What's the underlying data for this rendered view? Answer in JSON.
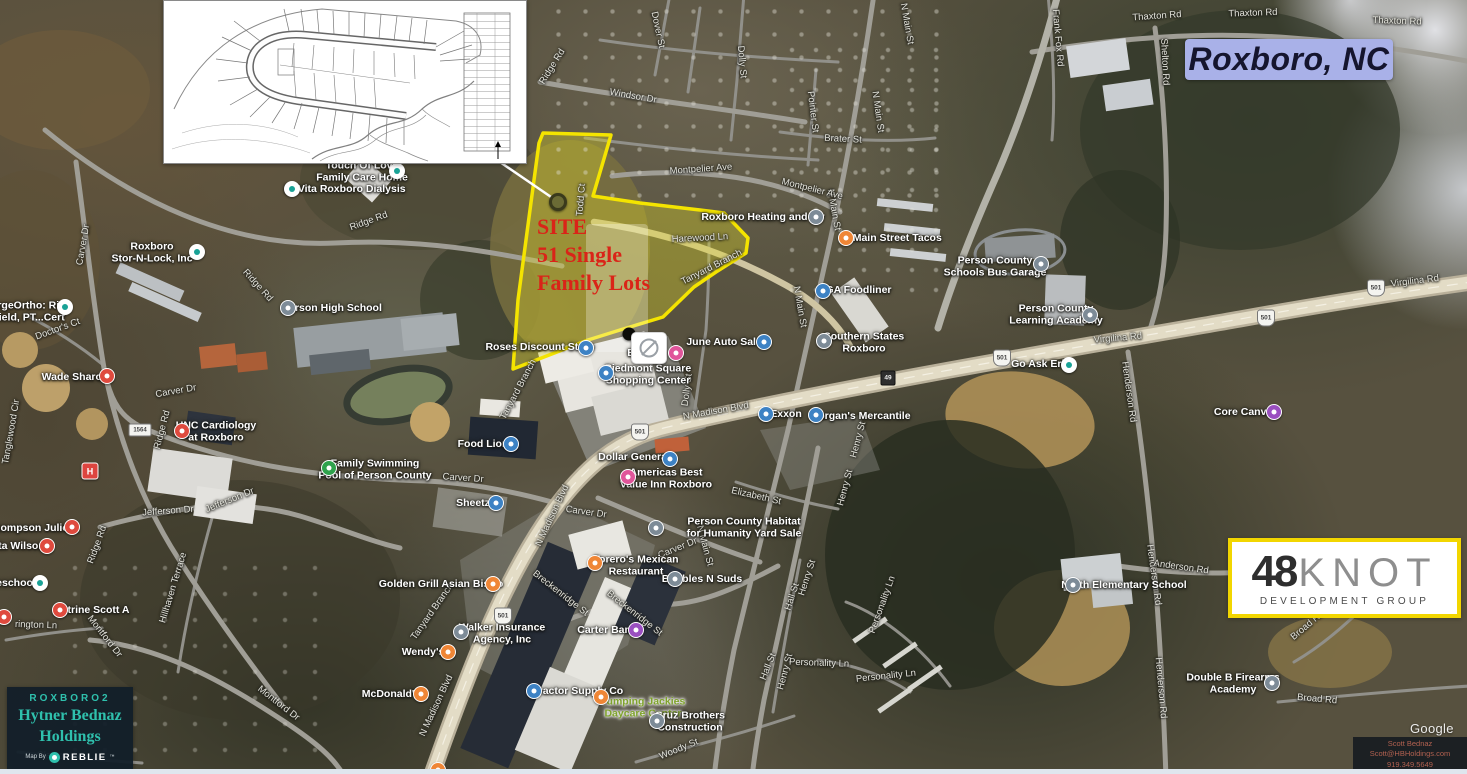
{
  "title": "Roxboro, NC",
  "callout": {
    "line1": "SITE",
    "line2": "51 Single",
    "line3": "Family Lots"
  },
  "logo": {
    "number": "48",
    "word": "KNOT",
    "subtitle": "DEVELOPMENT GROUP"
  },
  "branding": {
    "project": "ROXBORO2",
    "company_line1": "Hytner Bednaz",
    "company_line2": "Holdings",
    "map_by": "Map By",
    "brand": "REBLIE",
    "trademark": "™"
  },
  "contact": {
    "name": "Scott Bednaz",
    "email": "Scott@HBHoldings.com",
    "phone": "919.349.5649"
  },
  "watermark": "Google",
  "colors": {
    "site_outline": "#f4e400",
    "callout_red": "#da2418",
    "title_bg": "#a9b1e8",
    "brand_teal": "#2fc0ad",
    "logo_border_yellow": "#f2d600",
    "green_label": "#7fa32c"
  },
  "map": {
    "labels": [
      {
        "t": "Thaxton Rd",
        "x": 1157,
        "y": 17,
        "r": -4
      },
      {
        "t": "Thaxton Rd",
        "x": 1253,
        "y": 14,
        "r": -2
      },
      {
        "t": "Thaxton Rd",
        "x": 1397,
        "y": 22,
        "r": 2
      },
      {
        "t": "Frank Fox Rd",
        "x": 1057,
        "y": 38,
        "r": 85
      },
      {
        "t": "Shelton Rd",
        "x": 1164,
        "y": 62,
        "r": 87
      },
      {
        "t": "Ridge Rd",
        "x": 553,
        "y": 67,
        "r": -58
      },
      {
        "t": "Dover St",
        "x": 657,
        "y": 30,
        "r": 78
      },
      {
        "t": "Dolly St",
        "x": 741,
        "y": 62,
        "r": 85
      },
      {
        "t": "Windsor Dr",
        "x": 633,
        "y": 97,
        "r": 10
      },
      {
        "t": "Pointer St",
        "x": 812,
        "y": 112,
        "r": 83
      },
      {
        "t": "Brater St",
        "x": 843,
        "y": 140,
        "r": 3
      },
      {
        "t": "N Main St",
        "x": 906,
        "y": 24,
        "r": 80
      },
      {
        "t": "N Main St",
        "x": 877,
        "y": 112,
        "r": 82
      },
      {
        "t": "N Main St",
        "x": 833,
        "y": 210,
        "r": 80
      },
      {
        "t": "N Main St",
        "x": 799,
        "y": 307,
        "r": 80
      },
      {
        "t": "N Main St",
        "x": 704,
        "y": 546,
        "r": 75
      },
      {
        "t": "Montpelier Ave",
        "x": 701,
        "y": 170,
        "r": -4
      },
      {
        "t": "Montpelier Ave",
        "x": 812,
        "y": 190,
        "r": 14
      },
      {
        "t": "Todd Ct",
        "x": 582,
        "y": 200,
        "r": -85
      },
      {
        "t": "Harewood Ln",
        "x": 700,
        "y": 239,
        "r": -3
      },
      {
        "t": "Tanyard Branch",
        "x": 712,
        "y": 268,
        "r": -27
      },
      {
        "t": "Tanyard Branch",
        "x": 519,
        "y": 390,
        "r": -62
      },
      {
        "t": "Tanyard Branch",
        "x": 433,
        "y": 612,
        "r": -55
      },
      {
        "t": "Ridge Rd",
        "x": 369,
        "y": 222,
        "r": -20
      },
      {
        "t": "Ridge Rd",
        "x": 257,
        "y": 286,
        "r": 48
      },
      {
        "t": "Ridge Rd",
        "x": 163,
        "y": 430,
        "r": -75
      },
      {
        "t": "Ridge Rd",
        "x": 98,
        "y": 545,
        "r": -70
      },
      {
        "t": "Carver Dr",
        "x": 84,
        "y": 245,
        "r": -80
      },
      {
        "t": "Doctor's Ct",
        "x": 58,
        "y": 330,
        "r": -20
      },
      {
        "t": "Carver Dr",
        "x": 176,
        "y": 392,
        "r": -10
      },
      {
        "t": "Carver Dr",
        "x": 463,
        "y": 479,
        "r": 4
      },
      {
        "t": "Carver Dr",
        "x": 586,
        "y": 513,
        "r": 8
      },
      {
        "t": "Carver Dr",
        "x": 678,
        "y": 549,
        "r": -22
      },
      {
        "t": "Jefferson Dr",
        "x": 168,
        "y": 512,
        "r": -4
      },
      {
        "t": "Jefferson Dr",
        "x": 230,
        "y": 501,
        "r": -22
      },
      {
        "t": "Hillhaven Terrace",
        "x": 174,
        "y": 588,
        "r": -73
      },
      {
        "t": "Montford Dr",
        "x": 104,
        "y": 637,
        "r": 52
      },
      {
        "t": "Montford Dr",
        "x": 278,
        "y": 704,
        "r": 38
      },
      {
        "t": "rington Ln",
        "x": 36,
        "y": 626,
        "r": 2
      },
      {
        "t": "Clayton Ave",
        "x": 62,
        "y": 757,
        "r": 2
      },
      {
        "t": "Tanglewood Cir",
        "x": 12,
        "y": 432,
        "r": -80
      },
      {
        "t": "Breckenridge St",
        "x": 560,
        "y": 594,
        "r": 38
      },
      {
        "t": "Breckenridge St",
        "x": 634,
        "y": 614,
        "r": 38
      },
      {
        "t": "N Madison Blvd",
        "x": 716,
        "y": 412,
        "r": -10
      },
      {
        "t": "N Madison Blvd",
        "x": 553,
        "y": 516,
        "r": -65
      },
      {
        "t": "N Madison Blvd",
        "x": 437,
        "y": 706,
        "r": -65
      },
      {
        "t": "Virgilina Rd",
        "x": 1118,
        "y": 339,
        "r": -5
      },
      {
        "t": "Virgilina Rd",
        "x": 1415,
        "y": 282,
        "r": -7
      },
      {
        "t": "Henderson Rd",
        "x": 1128,
        "y": 392,
        "r": 82
      },
      {
        "t": "Henderson Rd",
        "x": 1153,
        "y": 575,
        "r": 82
      },
      {
        "t": "Henderson Rd",
        "x": 1160,
        "y": 688,
        "r": 85
      },
      {
        "t": "Anderson Rd",
        "x": 1181,
        "y": 568,
        "r": 8
      },
      {
        "t": "Woody St",
        "x": 679,
        "y": 750,
        "r": -22
      },
      {
        "t": "Elizabeth St",
        "x": 756,
        "y": 497,
        "r": 13
      },
      {
        "t": "Henry St",
        "x": 859,
        "y": 440,
        "r": -75
      },
      {
        "t": "Henry St",
        "x": 846,
        "y": 488,
        "r": -75
      },
      {
        "t": "Henry St",
        "x": 808,
        "y": 578,
        "r": -72
      },
      {
        "t": "Henry St",
        "x": 786,
        "y": 672,
        "r": -75
      },
      {
        "t": "Hall St",
        "x": 793,
        "y": 597,
        "r": -72
      },
      {
        "t": "Hall St",
        "x": 769,
        "y": 667,
        "r": -68
      },
      {
        "t": "Personality Ln",
        "x": 819,
        "y": 664,
        "r": 2
      },
      {
        "t": "Personality Ln",
        "x": 886,
        "y": 677,
        "r": -6
      },
      {
        "t": "Personality Ln",
        "x": 883,
        "y": 605,
        "r": -70
      },
      {
        "t": "Dolly St",
        "x": 688,
        "y": 390,
        "r": -83
      },
      {
        "t": "Broad Rd",
        "x": 1308,
        "y": 626,
        "r": -40
      },
      {
        "t": "Broad Rd",
        "x": 1317,
        "y": 700,
        "r": 5
      },
      {
        "t": [
          "Touch Of Love",
          "Family Care Home"
        ],
        "x": 362,
        "y": 172,
        "k": "p"
      },
      {
        "t": "DaVita Roxboro Dialysis",
        "x": 345,
        "y": 190,
        "k": "p"
      },
      {
        "t": [
          "Roxboro",
          "Stor-N-Lock, Inc"
        ],
        "x": 152,
        "y": 253,
        "k": "p"
      },
      {
        "t": "Person High School",
        "x": 332,
        "y": 309,
        "k": "p"
      },
      {
        "t": [
          "ergeOrtho: Rita",
          "field, PT...Cert"
        ],
        "x": 30,
        "y": 312,
        "k": "p"
      },
      {
        "t": "Wade Sharon",
        "x": 75,
        "y": 378,
        "k": "p"
      },
      {
        "t": [
          "UNC Cardiology",
          "at Roxboro"
        ],
        "x": 216,
        "y": 432,
        "k": "p"
      },
      {
        "t": "Thompson Julie A",
        "x": 33,
        "y": 529,
        "k": "p"
      },
      {
        "t": "ita Wilson",
        "x": 20,
        "y": 547,
        "k": "p"
      },
      {
        "t": "eschool",
        "x": 16,
        "y": 584,
        "k": "p"
      },
      {
        "t": "Strine Scott A",
        "x": 95,
        "y": 611,
        "k": "p"
      },
      {
        "t": [
          "Family Swimming",
          "Pool of Person County"
        ],
        "x": 375,
        "y": 470,
        "k": "p"
      },
      {
        "t": "Food Lion",
        "x": 483,
        "y": 445,
        "k": "p"
      },
      {
        "t": "Sheetz",
        "x": 473,
        "y": 504,
        "k": "p"
      },
      {
        "t": "Golden Grill Asian Bistro",
        "x": 441,
        "y": 585,
        "k": "p"
      },
      {
        "t": [
          "Torero's Mexican",
          "Restaurant"
        ],
        "x": 636,
        "y": 566,
        "k": "p"
      },
      {
        "t": [
          "Walker Insurance",
          "Agency, Inc"
        ],
        "x": 502,
        "y": 634,
        "k": "p"
      },
      {
        "t": "Wendy's",
        "x": 423,
        "y": 653,
        "k": "p"
      },
      {
        "t": "McDonald's",
        "x": 391,
        "y": 695,
        "k": "p"
      },
      {
        "t": "Tractor Supply Co",
        "x": 578,
        "y": 692,
        "k": "p"
      },
      {
        "t": [
          "Jumping Jackies",
          "Daycare Center"
        ],
        "x": 643,
        "y": 708,
        "k": "g"
      },
      {
        "t": [
          "Cruz Brothers",
          "Construction"
        ],
        "x": 690,
        "y": 722,
        "k": "p"
      },
      {
        "t": "Carter Bank",
        "x": 607,
        "y": 631,
        "k": "p"
      },
      {
        "t": "Bubbles N Suds",
        "x": 702,
        "y": 580,
        "k": "p"
      },
      {
        "t": [
          "Person County Habitat",
          "for Humanity Yard Sale"
        ],
        "x": 744,
        "y": 528,
        "k": "p"
      },
      {
        "t": [
          "Piedmont Square",
          "Shopping Center"
        ],
        "x": 648,
        "y": 375,
        "k": "p"
      },
      {
        "t": "Roses Discount Store",
        "x": 540,
        "y": 348,
        "k": "p"
      },
      {
        "t": "Dollar General",
        "x": 634,
        "y": 458,
        "k": "p"
      },
      {
        "t": [
          "Americas Best",
          "Value Inn Roxboro"
        ],
        "x": 666,
        "y": 479,
        "k": "p"
      },
      {
        "t": "Exxon",
        "x": 786,
        "y": 415,
        "k": "p"
      },
      {
        "t": "Morgan's Mercantile",
        "x": 860,
        "y": 417,
        "k": "p"
      },
      {
        "t": [
          "Southern States",
          "Roxboro"
        ],
        "x": 864,
        "y": 343,
        "k": "p"
      },
      {
        "t": "IGA Foodliner",
        "x": 857,
        "y": 291,
        "k": "p"
      },
      {
        "t": "N Main Street Tacos",
        "x": 892,
        "y": 239,
        "k": "p"
      },
      {
        "t": "Roxboro Heating and Air",
        "x": 763,
        "y": 218,
        "k": "p"
      },
      {
        "t": "June Auto Sales",
        "x": 727,
        "y": 343,
        "k": "p"
      },
      {
        "t": [
          "Person County",
          "Schools Bus Garage"
        ],
        "x": 995,
        "y": 267,
        "k": "p"
      },
      {
        "t": [
          "Person County",
          "Learning Academy"
        ],
        "x": 1056,
        "y": 315,
        "k": "p"
      },
      {
        "t": "Go Ask Erin",
        "x": 1041,
        "y": 365,
        "k": "p"
      },
      {
        "t": "Core Canvas",
        "x": 1246,
        "y": 413,
        "k": "p"
      },
      {
        "t": "North Elementary School",
        "x": 1124,
        "y": 586,
        "k": "p"
      },
      {
        "t": [
          "Double B Firearms",
          "Academy"
        ],
        "x": 1233,
        "y": 684,
        "k": "p"
      },
      {
        "t": "B",
        "x": 631,
        "y": 354,
        "k": "p"
      }
    ],
    "pins": [
      {
        "x": 397,
        "y": 171,
        "c": "white"
      },
      {
        "x": 292,
        "y": 189,
        "c": "white"
      },
      {
        "x": 197,
        "y": 252,
        "c": "white"
      },
      {
        "x": 288,
        "y": 308,
        "c": "gray"
      },
      {
        "x": 65,
        "y": 307,
        "c": "white"
      },
      {
        "x": 107,
        "y": 376,
        "c": "red"
      },
      {
        "x": 182,
        "y": 431,
        "c": "red"
      },
      {
        "x": 90,
        "y": 471,
        "c": "hosp",
        "g": "H"
      },
      {
        "x": 72,
        "y": 527,
        "c": "red"
      },
      {
        "x": 47,
        "y": 546,
        "c": "red"
      },
      {
        "x": 40,
        "y": 583,
        "c": "white"
      },
      {
        "x": 60,
        "y": 610,
        "c": "red"
      },
      {
        "x": 4,
        "y": 617,
        "c": "red"
      },
      {
        "x": 329,
        "y": 468,
        "c": "green"
      },
      {
        "x": 511,
        "y": 444,
        "c": "blue"
      },
      {
        "x": 496,
        "y": 503,
        "c": "blue"
      },
      {
        "x": 493,
        "y": 584,
        "c": "orange"
      },
      {
        "x": 595,
        "y": 563,
        "c": "orange"
      },
      {
        "x": 461,
        "y": 632,
        "c": "gray"
      },
      {
        "x": 448,
        "y": 652,
        "c": "orange"
      },
      {
        "x": 421,
        "y": 694,
        "c": "orange"
      },
      {
        "x": 534,
        "y": 691,
        "c": "blue"
      },
      {
        "x": 601,
        "y": 697,
        "c": "orange"
      },
      {
        "x": 657,
        "y": 721,
        "c": "gray"
      },
      {
        "x": 636,
        "y": 630,
        "c": "purple"
      },
      {
        "x": 675,
        "y": 579,
        "c": "gray"
      },
      {
        "x": 656,
        "y": 528,
        "c": "gray"
      },
      {
        "x": 606,
        "y": 373,
        "c": "blue"
      },
      {
        "x": 586,
        "y": 348,
        "c": "blue"
      },
      {
        "x": 670,
        "y": 459,
        "c": "blue"
      },
      {
        "x": 628,
        "y": 477,
        "c": "pink"
      },
      {
        "x": 766,
        "y": 414,
        "c": "blue"
      },
      {
        "x": 816,
        "y": 415,
        "c": "blue"
      },
      {
        "x": 824,
        "y": 341,
        "c": "gray"
      },
      {
        "x": 823,
        "y": 291,
        "c": "blue"
      },
      {
        "x": 846,
        "y": 238,
        "c": "orange"
      },
      {
        "x": 816,
        "y": 217,
        "c": "gray"
      },
      {
        "x": 764,
        "y": 342,
        "c": "blue"
      },
      {
        "x": 1041,
        "y": 264,
        "c": "gray"
      },
      {
        "x": 1090,
        "y": 315,
        "c": "gray"
      },
      {
        "x": 1069,
        "y": 365,
        "c": "white"
      },
      {
        "x": 1274,
        "y": 412,
        "c": "purple"
      },
      {
        "x": 1073,
        "y": 585,
        "c": "gray"
      },
      {
        "x": 1272,
        "y": 683,
        "c": "gray"
      },
      {
        "x": 629,
        "y": 334,
        "c": "dot"
      },
      {
        "x": 558,
        "y": 202,
        "c": "sitedot"
      },
      {
        "x": 649,
        "y": 348,
        "c": "photo"
      },
      {
        "x": 676,
        "y": 353,
        "c": "pink"
      },
      {
        "x": 438,
        "y": 770,
        "c": "orange"
      }
    ],
    "shields": [
      {
        "t": "501",
        "x": 640,
        "y": 432,
        "s": "us"
      },
      {
        "t": "501",
        "x": 1002,
        "y": 358,
        "s": "us"
      },
      {
        "t": "501",
        "x": 1266,
        "y": 318,
        "s": "us"
      },
      {
        "t": "501",
        "x": 1376,
        "y": 288,
        "s": "us"
      },
      {
        "t": "501",
        "x": 503,
        "y": 616,
        "s": "us"
      },
      {
        "t": "49",
        "x": 888,
        "y": 378,
        "s": "sq"
      },
      {
        "t": "1564",
        "x": 140,
        "y": 430,
        "s": "rect"
      }
    ]
  }
}
